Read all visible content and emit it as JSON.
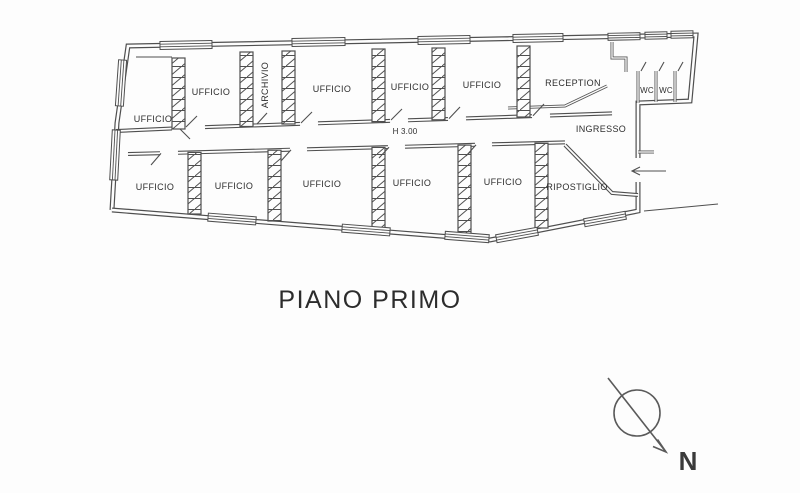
{
  "plan": {
    "title": "PIANO PRIMO",
    "height_note": "H 3.00",
    "entrance_label": "INGRESSO",
    "compass_label": "N",
    "top_rooms": [
      "UFFICIO",
      "UFFICIO",
      "ARCHIVIO",
      "UFFICIO",
      "UFFICIO",
      "UFFICIO",
      "RECEPTION",
      "WC",
      "WC"
    ],
    "bottom_rooms": [
      "UFFICIO",
      "UFFICIO",
      "UFFICIO",
      "UFFICIO",
      "UFFICIO",
      "RIPOSTIGLIO"
    ],
    "colors": {
      "ink": "#4f4f4f",
      "text": "#2e2e2e",
      "paper": "#fdfdfd"
    }
  }
}
